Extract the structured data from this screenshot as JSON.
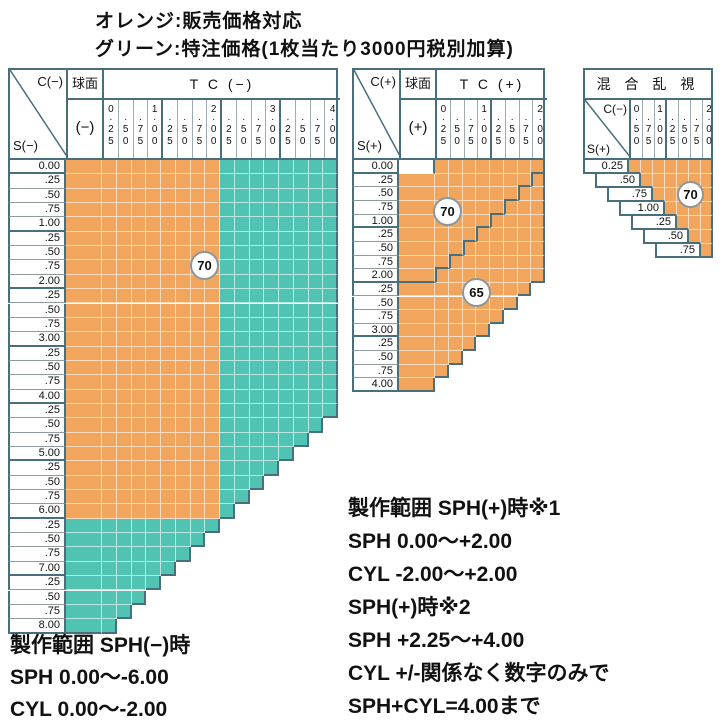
{
  "legend": {
    "orange_line": "オレンジ:販売価格対応",
    "green_line": "グリーン:特注価格(1枚当たり3000円税別加算)"
  },
  "colors": {
    "orange": "#F2A55C",
    "green": "#51C3B3",
    "border": "#47707C"
  },
  "charts": {
    "minus": {
      "corner_col": "C(−)",
      "corner_row": "S(−)",
      "sphere_title": "球面",
      "sphere_sign": "(−)",
      "tc_title": "T C (−)",
      "cols": [
        {
          "i": "0",
          "d": "25"
        },
        {
          "i": "",
          "d": "50"
        },
        {
          "i": "",
          "d": "75"
        },
        {
          "i": "1",
          "d": "00"
        },
        {
          "i": "",
          "d": "25"
        },
        {
          "i": "",
          "d": "50"
        },
        {
          "i": "",
          "d": "75"
        },
        {
          "i": "2",
          "d": "00"
        },
        {
          "i": "",
          "d": "25"
        },
        {
          "i": "",
          "d": "50"
        },
        {
          "i": "",
          "d": "75"
        },
        {
          "i": "3",
          "d": "00"
        },
        {
          "i": "",
          "d": "25"
        },
        {
          "i": "",
          "d": "50"
        },
        {
          "i": "",
          "d": "75"
        },
        {
          "i": "4",
          "d": "00"
        }
      ],
      "rows": [
        "0.00",
        ".25",
        ".50",
        ".75",
        "1.00",
        ".25",
        ".50",
        ".75",
        "2.00",
        ".25",
        ".50",
        ".75",
        "3.00",
        ".25",
        ".50",
        ".75",
        "4.00",
        ".25",
        ".50",
        ".75",
        "5.00",
        ".25",
        ".50",
        ".75",
        "6.00",
        ".25",
        ".50",
        ".75",
        "7.00",
        ".25",
        ".50",
        ".75",
        "8.00"
      ],
      "rules": {
        "max_sum_quarters": 33,
        "orange_max_col": 8,
        "orange_max_row": 24
      },
      "badges": [
        {
          "text": "70"
        }
      ]
    },
    "plus": {
      "corner_col": "C(+)",
      "corner_row": "S(+)",
      "sphere_title": "球面",
      "sphere_sign": "(+)",
      "tc_title": "T C (+)",
      "cols": [
        {
          "i": "0",
          "d": "25"
        },
        {
          "i": "",
          "d": "50"
        },
        {
          "i": "",
          "d": "75"
        },
        {
          "i": "1",
          "d": "00"
        },
        {
          "i": "",
          "d": "25"
        },
        {
          "i": "",
          "d": "50"
        },
        {
          "i": "",
          "d": "75"
        },
        {
          "i": "2",
          "d": "00"
        }
      ],
      "rows": [
        "0.00",
        ".25",
        ".50",
        ".75",
        "1.00",
        ".25",
        ".50",
        ".75",
        "2.00",
        ".25",
        ".50",
        ".75",
        "3.00",
        ".25",
        ".50",
        ".75",
        "4.00"
      ],
      "rules": {
        "max_sum_quarters": 16,
        "inner_boundary_sum": 8
      },
      "badges": [
        {
          "text": "70"
        },
        {
          "text": "65"
        }
      ]
    },
    "mixed": {
      "title": "混 合 乱 視",
      "corner_col": "C(−)",
      "corner_row": "S(+)",
      "cols": [
        {
          "i": "0",
          "d": "50"
        },
        {
          "i": "",
          "d": "75"
        },
        {
          "i": "1",
          "d": "00"
        },
        {
          "i": "",
          "d": "25"
        },
        {
          "i": "",
          "d": "50"
        },
        {
          "i": "",
          "d": "75"
        },
        {
          "i": "2",
          "d": "00"
        }
      ],
      "rows": [
        "0.25",
        ".50",
        ".75",
        "1.00",
        ".25",
        ".50",
        ".75"
      ],
      "rules": {
        "diagonal": true
      },
      "badges": [
        {
          "text": "70"
        }
      ]
    }
  },
  "notes_minus": {
    "lines": [
      "製作範囲 SPH(−)時",
      "SPH 0.00〜-6.00",
      "CYL 0.00〜-2.00"
    ]
  },
  "notes_plus": {
    "lines": [
      "製作範囲 SPH(+)時※1",
      "SPH 0.00〜+2.00",
      "CYL -2.00〜+2.00",
      "SPH(+)時※2",
      "SPH +2.25〜+4.00",
      "CYL +/-関係なく数字のみで",
      "SPH+CYL=4.00まで"
    ]
  },
  "chart_data": [
    {
      "type": "heatmap",
      "title": "TC(−) S(−)×C(−)",
      "x_categories": [
        0.25,
        0.5,
        0.75,
        1.0,
        1.25,
        1.5,
        1.75,
        2.0,
        2.25,
        2.5,
        2.75,
        3.0,
        3.25,
        3.5,
        3.75,
        4.0
      ],
      "y_categories": [
        0.0,
        0.25,
        0.5,
        0.75,
        1.0,
        1.25,
        1.5,
        1.75,
        2.0,
        2.25,
        2.5,
        2.75,
        3.0,
        3.25,
        3.5,
        3.75,
        4.0,
        4.25,
        4.5,
        4.75,
        5.0,
        5.25,
        5.5,
        5.75,
        6.0,
        6.25,
        6.5,
        6.75,
        7.0,
        7.25,
        7.5,
        7.75,
        8.0
      ],
      "cell_rule": "cell exists for sphere column always and where S+C <= 8.25",
      "regions": [
        {
          "color": "orange",
          "meaning": "販売価格対応",
          "range": "S 0.00〜6.00 × (球面 or C 0.25〜2.00)"
        },
        {
          "color": "green",
          "meaning": "特注価格 +3000円/枚 税別",
          "range": "remaining cells (C 2.25〜4.00 or S 6.25〜8.00)"
        }
      ],
      "diameter_badges": [
        {
          "value": 70
        }
      ]
    },
    {
      "type": "heatmap",
      "title": "TC(+) S(+)×C(+)",
      "x_categories": [
        0.25,
        0.5,
        0.75,
        1.0,
        1.25,
        1.5,
        1.75,
        2.0
      ],
      "y_categories": [
        0.0,
        0.25,
        0.5,
        0.75,
        1.0,
        1.25,
        1.5,
        1.75,
        2.0,
        2.25,
        2.5,
        2.75,
        3.0,
        3.25,
        3.5,
        3.75,
        4.0
      ],
      "cell_rule": "orange cells where S+C <= 4.00; plano cell (S=0, sphere) empty",
      "regions": [
        {
          "color": "orange",
          "meaning": "販売価格対応",
          "range": "S+C <= 4.00"
        }
      ],
      "diameter_badges": [
        {
          "value": 70,
          "range": "S+C <= 2.00"
        },
        {
          "value": 65,
          "range": "2.00 < S+C <= 4.00"
        }
      ]
    },
    {
      "type": "heatmap",
      "title": "混合乱視 S(+)×C(−)",
      "x_categories": [
        0.5,
        0.75,
        1.0,
        1.25,
        1.5,
        1.75,
        2.0
      ],
      "y_categories": [
        0.25,
        0.5,
        0.75,
        1.0,
        1.25,
        1.5,
        1.75
      ],
      "cell_rule": "orange cells where C >= S + 0.25",
      "regions": [
        {
          "color": "orange",
          "meaning": "販売価格対応",
          "range": "C >= S+0.25"
        }
      ],
      "diameter_badges": [
        {
          "value": 70
        }
      ]
    }
  ]
}
